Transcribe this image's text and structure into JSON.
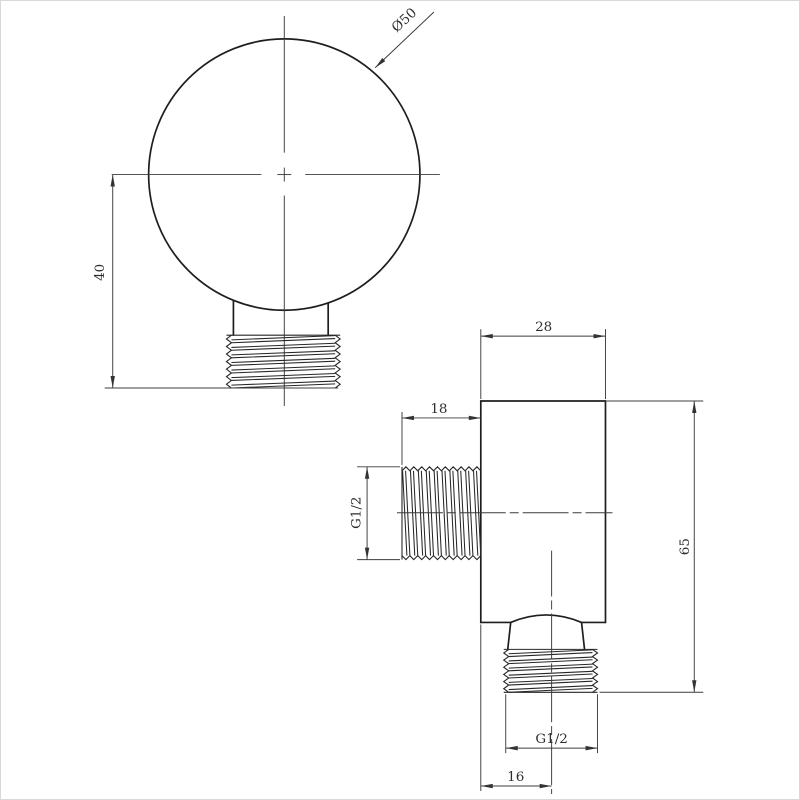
{
  "drawing": {
    "colors": {
      "ink": "#1e1e1e",
      "dimension_ink": "#3c3c3c",
      "background": "#ffffff"
    },
    "front_view": {
      "diameter_label": "Ø50",
      "height_label": "40"
    },
    "side_view": {
      "width_label": "28",
      "thread_length_label": "18",
      "side_thread_label": "G1/2",
      "height_label": "65",
      "bottom_thread_label": "G1/2",
      "offset_label": "16"
    }
  }
}
